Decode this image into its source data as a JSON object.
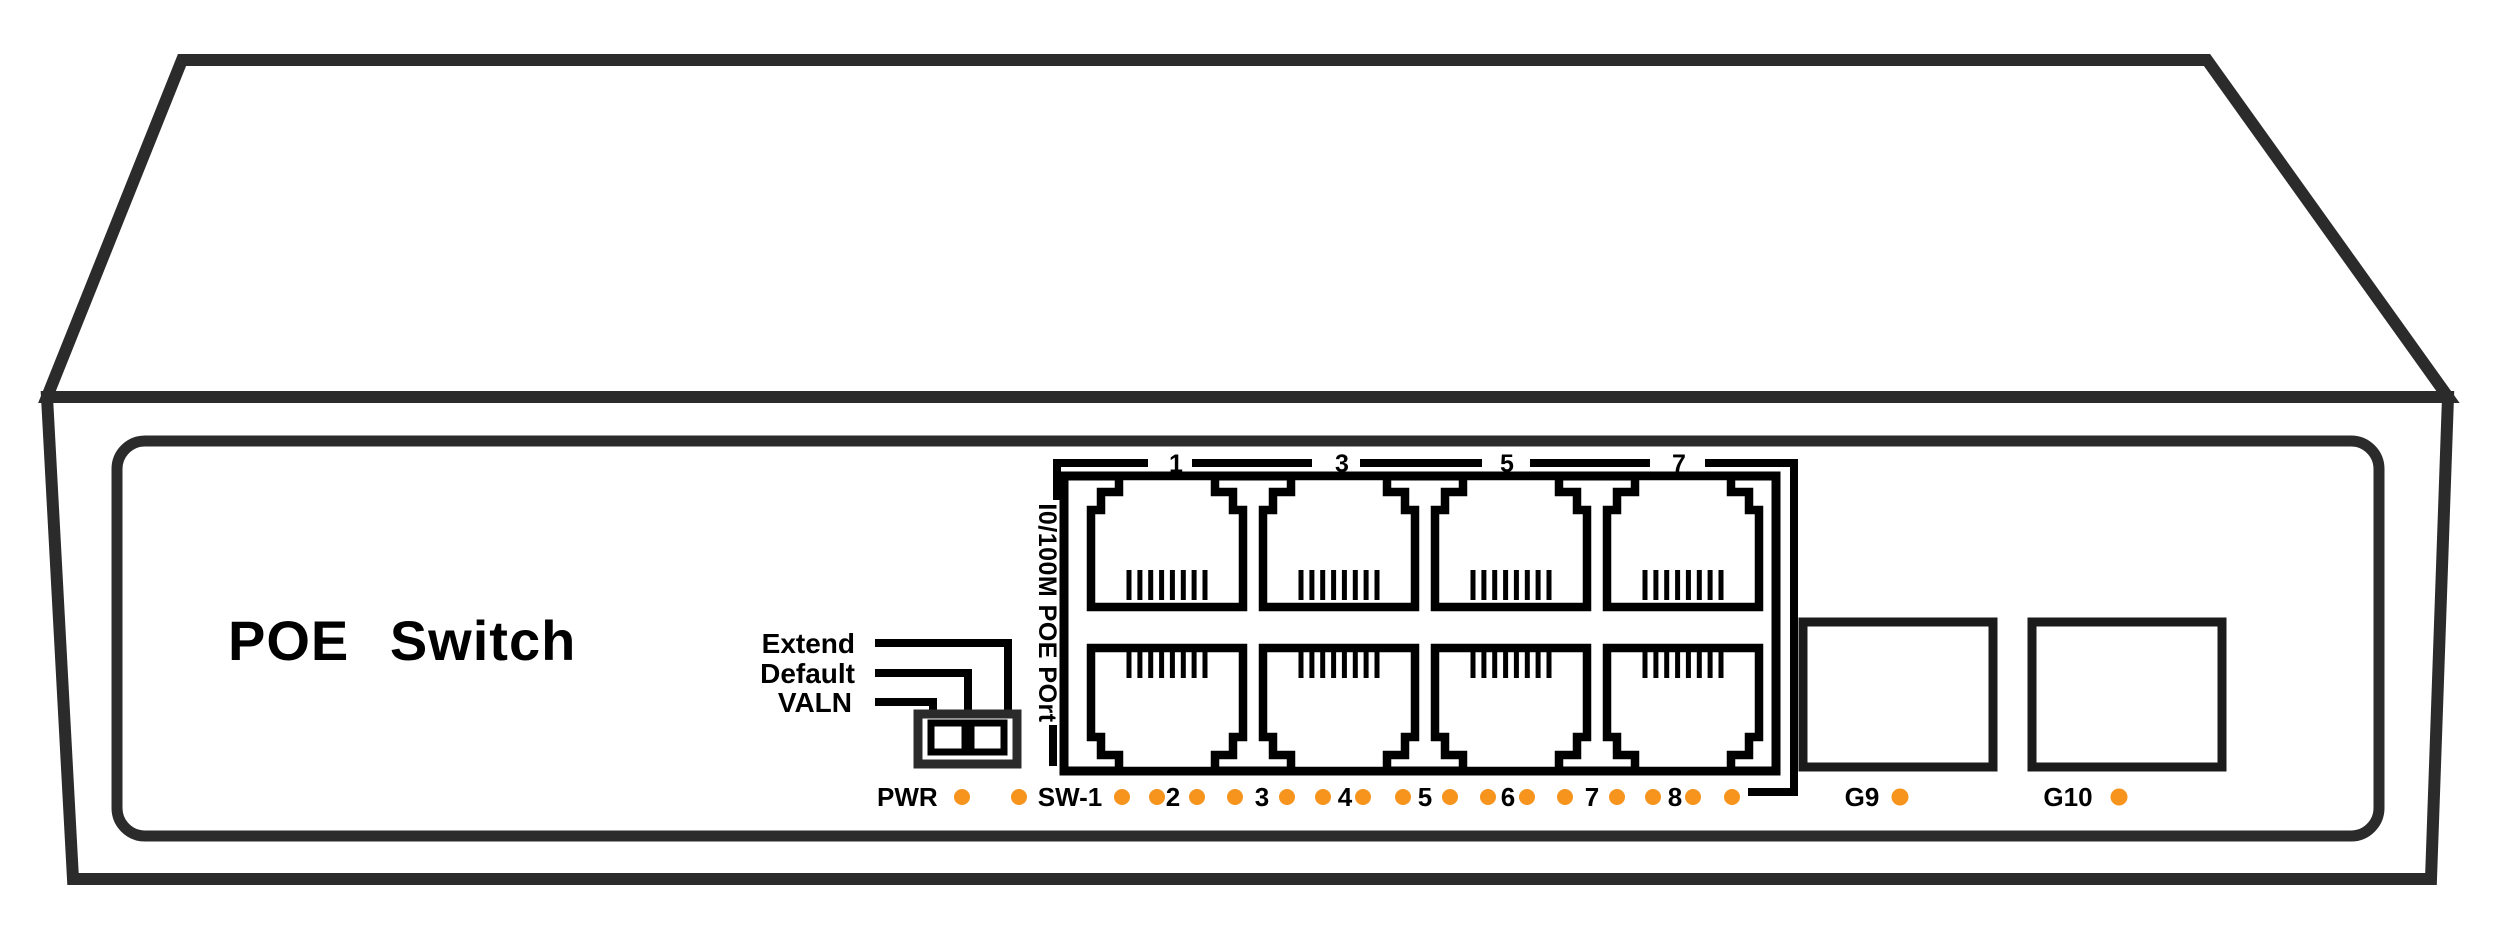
{
  "device": {
    "title": "POE Switch",
    "ports_group_label": "I0/100M POE POrt"
  },
  "dip_switch": {
    "labels": [
      "Extend",
      "Default",
      "VALN"
    ],
    "positions": 2
  },
  "top_port_numbers": [
    "1",
    "3",
    "5",
    "7"
  ],
  "led_row": {
    "power_label": "PWR",
    "switch_label": "SW-1",
    "port_labels": [
      "2",
      "3",
      "4",
      "5",
      "6",
      "7",
      "8"
    ],
    "led_count": 18
  },
  "uplink_ports": [
    {
      "label": "G9"
    },
    {
      "label": "G10"
    }
  ],
  "colors": {
    "led_orange": "#F7941E",
    "case_line": "#2B2B2B",
    "detail_line": "#000000"
  }
}
